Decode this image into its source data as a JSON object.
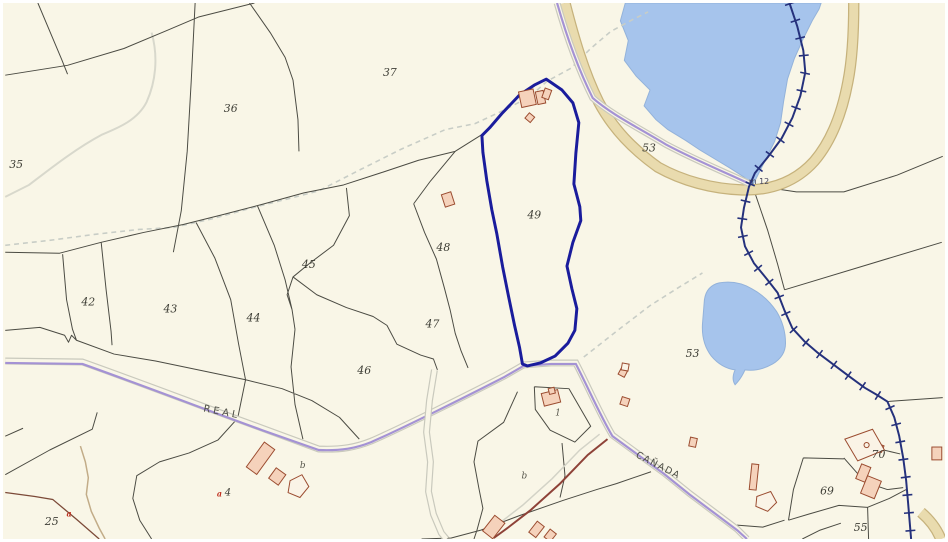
{
  "map": {
    "type": "cadastral-parcel-map",
    "selected_parcel": "49",
    "colors": {
      "background": "#f9f6e7",
      "water": "#a6c4ec",
      "road": "#e9dbae",
      "municipal_boundary": "#25317c",
      "selected_parcel_outline": "#1a1c9c",
      "livestock_route": "#a492d4",
      "building_fill": "#f5d2bb",
      "building_outline": "#9b4c30",
      "parcel_line": "#4b4b43"
    },
    "labels": [
      {
        "name": "parcel-35",
        "text": "35",
        "x": 4,
        "y": 167,
        "cls": "parcel"
      },
      {
        "name": "parcel-36",
        "text": "36",
        "x": 221,
        "y": 110,
        "cls": "parcel"
      },
      {
        "name": "parcel-37",
        "text": "37",
        "x": 382,
        "y": 74,
        "cls": "parcel"
      },
      {
        "name": "parcel-42",
        "text": "42",
        "x": 77,
        "y": 306,
        "cls": "parcel"
      },
      {
        "name": "parcel-43",
        "text": "43",
        "x": 160,
        "y": 313,
        "cls": "parcel"
      },
      {
        "name": "parcel-44",
        "text": "44",
        "x": 244,
        "y": 322,
        "cls": "parcel"
      },
      {
        "name": "parcel-45",
        "text": "45",
        "x": 300,
        "y": 268,
        "cls": "parcel"
      },
      {
        "name": "parcel-46",
        "text": "46",
        "x": 356,
        "y": 375,
        "cls": "parcel"
      },
      {
        "name": "parcel-47",
        "text": "47",
        "x": 425,
        "y": 328,
        "cls": "parcel"
      },
      {
        "name": "parcel-48",
        "text": "48",
        "x": 436,
        "y": 251,
        "cls": "parcel"
      },
      {
        "name": "parcel-49",
        "text": "49",
        "x": 528,
        "y": 218,
        "cls": "parcel"
      },
      {
        "name": "parcel-53-north",
        "text": "53",
        "x": 644,
        "y": 150,
        "cls": "parcel"
      },
      {
        "name": "parcel-53-south",
        "text": "53",
        "x": 688,
        "y": 358,
        "cls": "parcel"
      },
      {
        "name": "parcel-55",
        "text": "55",
        "x": 858,
        "y": 534,
        "cls": "parcel"
      },
      {
        "name": "parcel-69",
        "text": "69",
        "x": 824,
        "y": 497,
        "cls": "parcel"
      },
      {
        "name": "parcel-70",
        "text": "70",
        "x": 876,
        "y": 460,
        "cls": "parcel"
      },
      {
        "name": "parcel-25",
        "text": "25",
        "x": 40,
        "y": 528,
        "cls": "parcel"
      },
      {
        "name": "building-label-1",
        "text": "1",
        "x": 556,
        "y": 417,
        "cls": "letter"
      },
      {
        "name": "subparcel-4",
        "text": "4",
        "x": 222,
        "y": 498,
        "cls": "parcel-sm"
      },
      {
        "name": "marker-a-west",
        "text": "a",
        "x": 62,
        "y": 519,
        "cls": "red"
      },
      {
        "name": "marker-a-center",
        "text": "a",
        "x": 214,
        "y": 499,
        "cls": "red"
      },
      {
        "name": "subparcel-b-west",
        "text": "b",
        "x": 298,
        "y": 470,
        "cls": "letter"
      },
      {
        "name": "subparcel-b-center",
        "text": "b",
        "x": 522,
        "y": 481,
        "cls": "letter"
      },
      {
        "name": "route-label-real",
        "text": "REAL",
        "x": 200,
        "y": 413,
        "cls": "route",
        "rot": 11
      },
      {
        "name": "route-label-canada",
        "text": "CAÑADA",
        "x": 637,
        "y": 459,
        "cls": "canada",
        "rot": 27
      },
      {
        "name": "km-marker",
        "text": "m 12",
        "x": 752,
        "y": 183,
        "cls": "km"
      }
    ]
  }
}
